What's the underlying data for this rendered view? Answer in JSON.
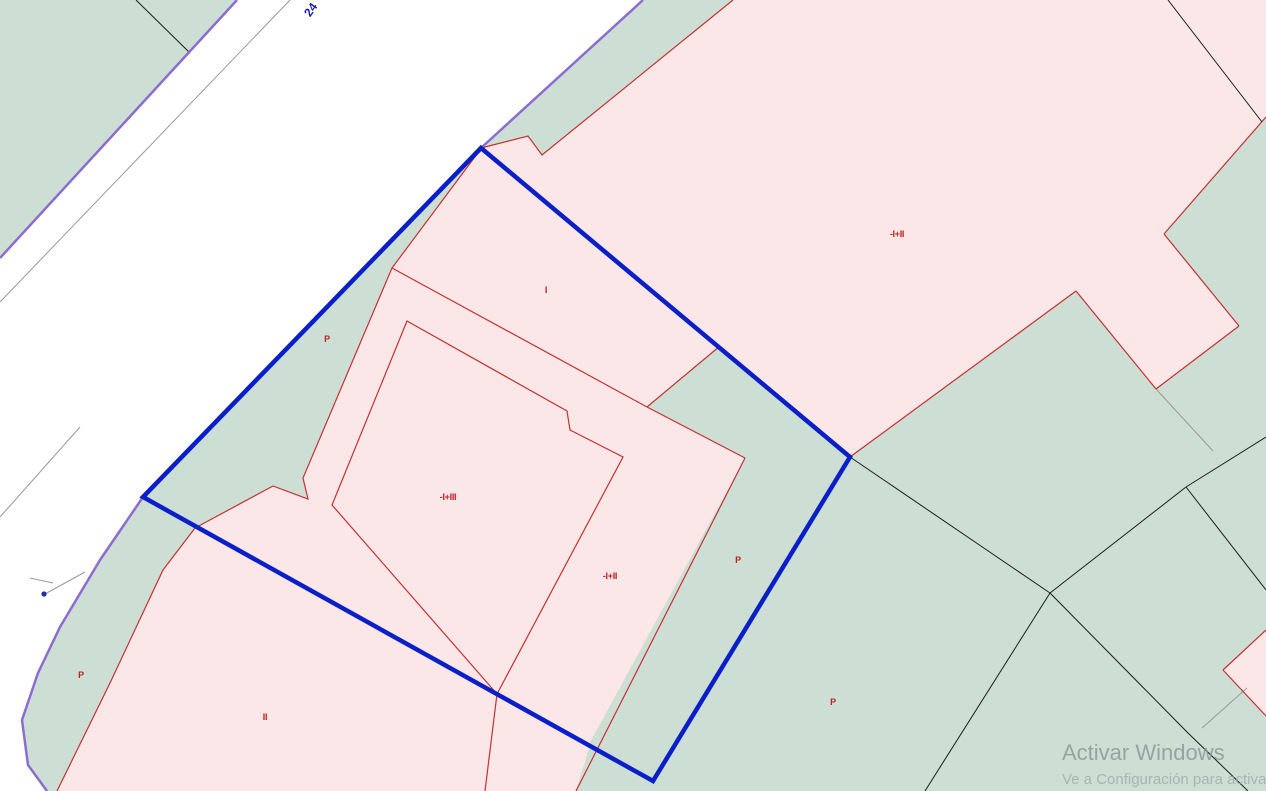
{
  "map": {
    "road_label": "24",
    "parcel_labels": [
      {
        "text": "-I+II",
        "x": 897,
        "y": 237
      },
      {
        "text": "I",
        "x": 546,
        "y": 293
      },
      {
        "text": "P",
        "x": 327,
        "y": 342
      },
      {
        "text": "-I+III",
        "x": 448,
        "y": 500
      },
      {
        "text": "-I+II",
        "x": 610,
        "y": 579
      },
      {
        "text": "P",
        "x": 738,
        "y": 563
      },
      {
        "text": "P",
        "x": 81,
        "y": 678
      },
      {
        "text": "II",
        "x": 265,
        "y": 720
      },
      {
        "text": "P",
        "x": 833,
        "y": 705
      }
    ],
    "watermark": {
      "line1": "Activar Windows",
      "line2": "Ve a Configuración para activar"
    },
    "colors": {
      "urban_parcel_fill": "#fbe7e7",
      "rural_parcel_fill": "#cddfd5",
      "road_fill": "#ffffff",
      "selected_parcel_outline": "#0a1fc8",
      "road_edge_line": "#8d6cd0",
      "parcel_line": "#c53030",
      "boundary_line": "#1b1b1b",
      "label_color": "#c02020"
    }
  }
}
